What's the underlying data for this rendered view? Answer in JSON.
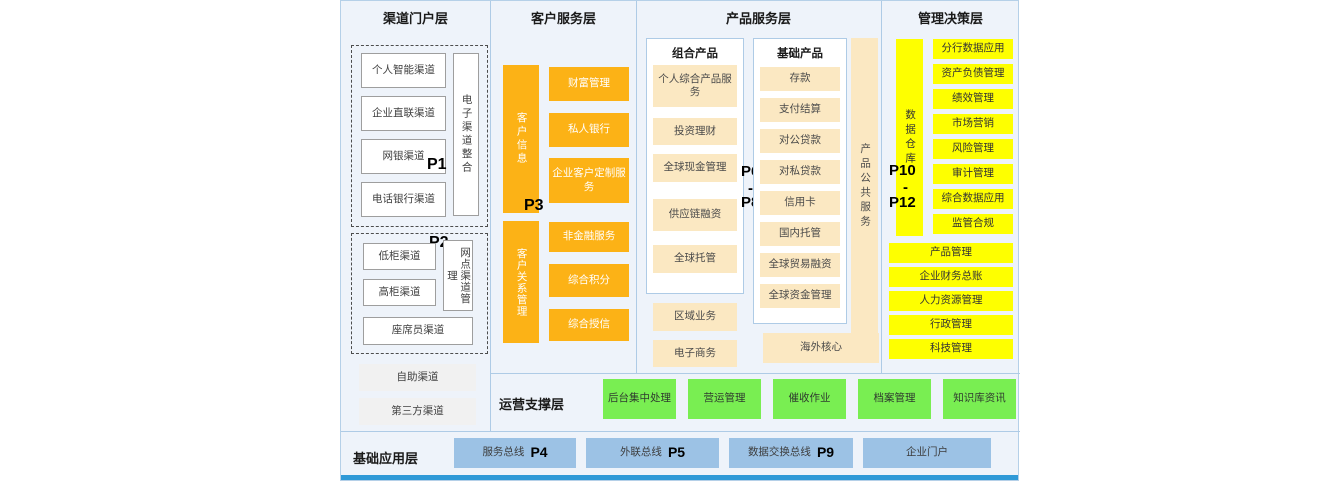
{
  "colors": {
    "panel_bg": "#eef3fa",
    "panel_border": "#b5d0e8",
    "orange": "#fcb216",
    "beige": "#fbe8c2",
    "yellow": "#feff00",
    "green": "#79ee52",
    "blue_box": "#9cc2e5",
    "bottom_strip": "#2f99d7"
  },
  "layers": {
    "channel": {
      "title": "渠道门户层",
      "p1": "P1",
      "p2": "P2",
      "group1": {
        "items": [
          "个人智能渠道",
          "企业直联渠道",
          "网银渠道",
          "电话银行渠道"
        ],
        "vertical": "电子渠道整合"
      },
      "group2": {
        "items": [
          "低柜渠道",
          "高柜渠道"
        ],
        "vertical": "网点渠道管理",
        "wide": "座席员渠道"
      },
      "extra": [
        "自助渠道",
        "第三方渠道"
      ]
    },
    "customer": {
      "title": "客户服务层",
      "p3": "P3",
      "bar1": "客户信息",
      "boxes1": [
        "财富管理",
        "私人银行",
        "企业客户定制服务"
      ],
      "bar2": "客户关系管理",
      "boxes2": [
        "非金融服务",
        "综合积分",
        "综合授信"
      ]
    },
    "product": {
      "title": "产品服务层",
      "p6": "P6",
      "dash": "-",
      "p8": "P8",
      "combo": {
        "title": "组合产品",
        "items": [
          "个人综合产品服务",
          "投资理财",
          "全球现金管理",
          "供应链融资",
          "全球托管"
        ]
      },
      "basic": {
        "title": "基础产品",
        "items": [
          "存款",
          "支付结算",
          "对公贷款",
          "对私贷款",
          "信用卡",
          "国内托管",
          "全球贸易融资",
          "全球资金管理"
        ]
      },
      "public_bar": "产品公共服务",
      "extra": [
        "区域业务",
        "电子商务"
      ],
      "overseas": "海外核心"
    },
    "management": {
      "title": "管理决策层",
      "p10": "P10",
      "dash": "-",
      "p12": "P12",
      "bar": "数据仓库",
      "items": [
        "分行数据应用",
        "资产负债管理",
        "绩效管理",
        "市场营销",
        "风险管理",
        "审计管理",
        "综合数据应用",
        "监管合规"
      ],
      "wide": [
        "产品管理",
        "企业财务总账",
        "人力资源管理",
        "行政管理",
        "科技管理"
      ]
    },
    "operations": {
      "title": "运营支撑层",
      "items": [
        "后台集中处理",
        "营运管理",
        "催收作业",
        "档案管理",
        "知识库资讯"
      ]
    },
    "foundation": {
      "title": "基础应用层",
      "items": [
        {
          "label": "服务总线",
          "p": "P4"
        },
        {
          "label": "外联总线",
          "p": "P5"
        },
        {
          "label": "数据交换总线",
          "p": "P9"
        },
        {
          "label": "企业门户",
          "p": ""
        }
      ]
    }
  }
}
